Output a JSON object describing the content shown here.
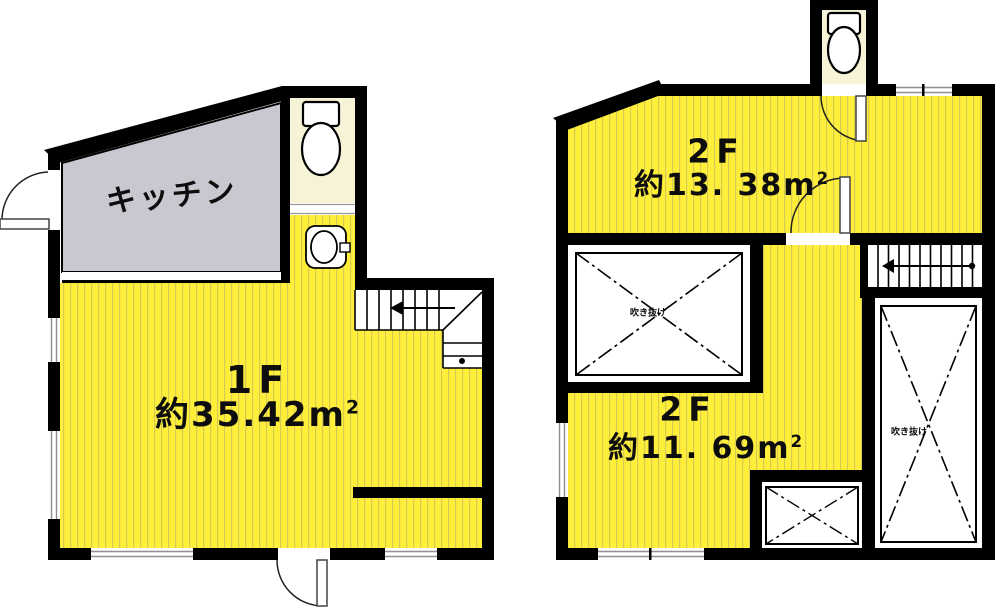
{
  "colors": {
    "room_yellow": "#ffef3b",
    "stripe": "#d6cb52",
    "kitchen_gray": "#c8c8d0",
    "toilet_cream": "#f7f3d6",
    "wall_black": "#000000"
  },
  "floor1": {
    "kitchen_label": "キッチン",
    "room": {
      "floor": "1F",
      "area": "約35.42",
      "unit_base": "m",
      "unit_sup": "2"
    }
  },
  "floor2": {
    "upper_room": {
      "floor": "2F",
      "area": "約13. 38",
      "unit_base": "m",
      "unit_sup": "2"
    },
    "lower_room": {
      "floor": "2F",
      "area": "約11. 69",
      "unit_base": "m",
      "unit_sup": "2"
    },
    "voids": {
      "left_label": "吹き抜け",
      "right_label": "吹き抜け"
    }
  },
  "icons": [
    "toilet-icon-1f",
    "sink-icon-1f",
    "toilet-icon-2f",
    "door-arc-1f-left",
    "door-arc-1f-bottom",
    "door-arc-2f-toilet",
    "door-arc-2f-room",
    "stair-arrow-1f",
    "stair-arrow-2f"
  ]
}
